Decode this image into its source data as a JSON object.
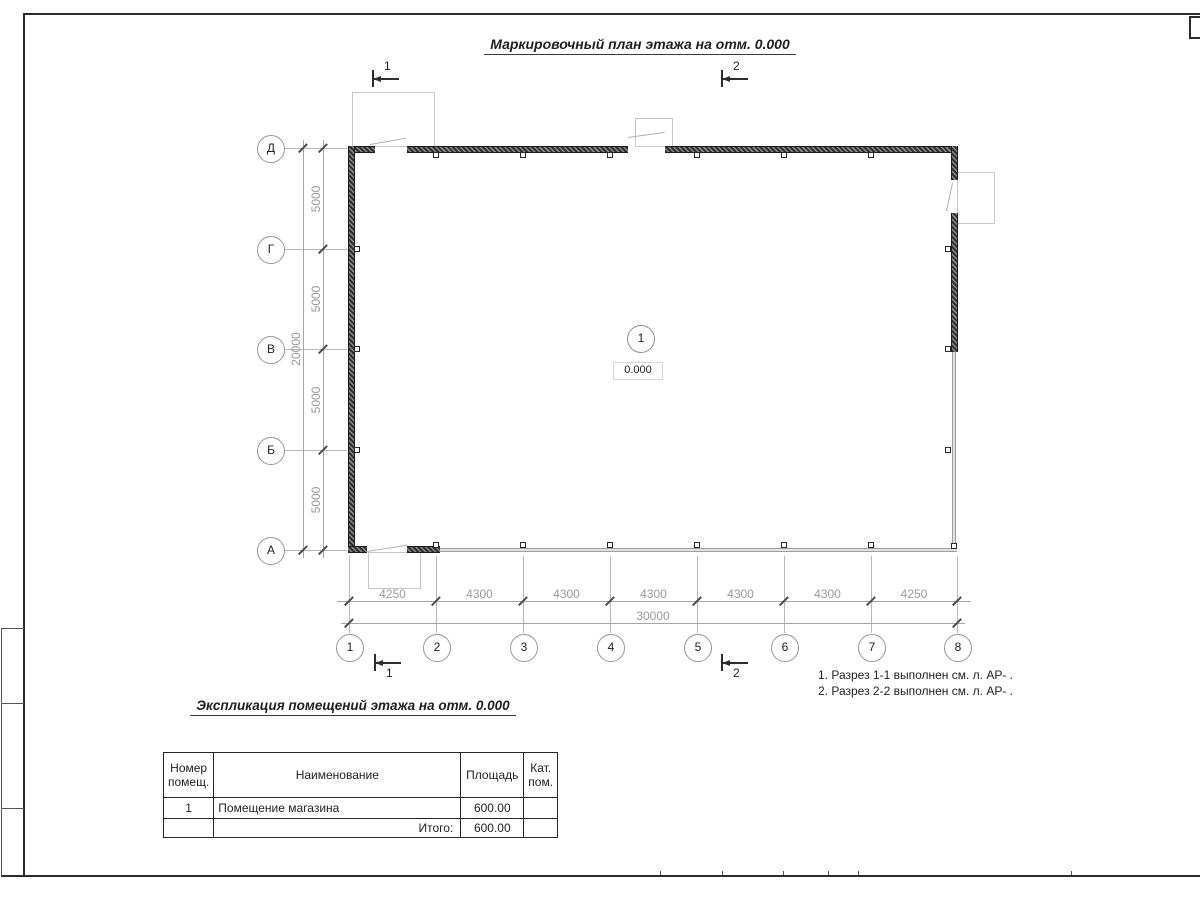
{
  "sheet": {
    "title": "Маркировочный план этажа на отм. 0.000"
  },
  "plan": {
    "room": {
      "number": "1",
      "elevation": "0.000"
    },
    "row_axes": [
      "Д",
      "Г",
      "В",
      "Б",
      "А"
    ],
    "col_axes": [
      "1",
      "2",
      "3",
      "4",
      "5",
      "6",
      "7",
      "8"
    ],
    "bottom_dims": [
      "4250",
      "4300",
      "4300",
      "4300",
      "4300",
      "4300",
      "4250"
    ],
    "bottom_total": "30000",
    "left_dims": [
      "5000",
      "5000",
      "5000",
      "5000"
    ],
    "left_total": "20000",
    "section_marks": {
      "top1": "1",
      "top2": "2",
      "bottom1": "1",
      "bottom2": "2"
    }
  },
  "notes": [
    "1. Разрез 1-1 выполнен см. л. АР- .",
    "2. Разрез 2-2 выполнен см. л. АР- ."
  ],
  "table": {
    "title": "Экспликация помещений этажа на отм. 0.000",
    "headers": [
      "Номер помещ.",
      "Наименование",
      "Площадь",
      "Кат. пом."
    ],
    "rows": [
      {
        "num": "1",
        "name": "Помещение магазина",
        "area": "600.00",
        "cat": ""
      }
    ],
    "total_label": "Итого:",
    "total_value": "600.00"
  },
  "colors": {
    "frame": "#2b2b2b",
    "wall_dark": "#2e2e2e",
    "wall_light": "#c9c9c9",
    "dim_gray": "#9a9a9a",
    "text_dark": "#1f1f1f"
  }
}
